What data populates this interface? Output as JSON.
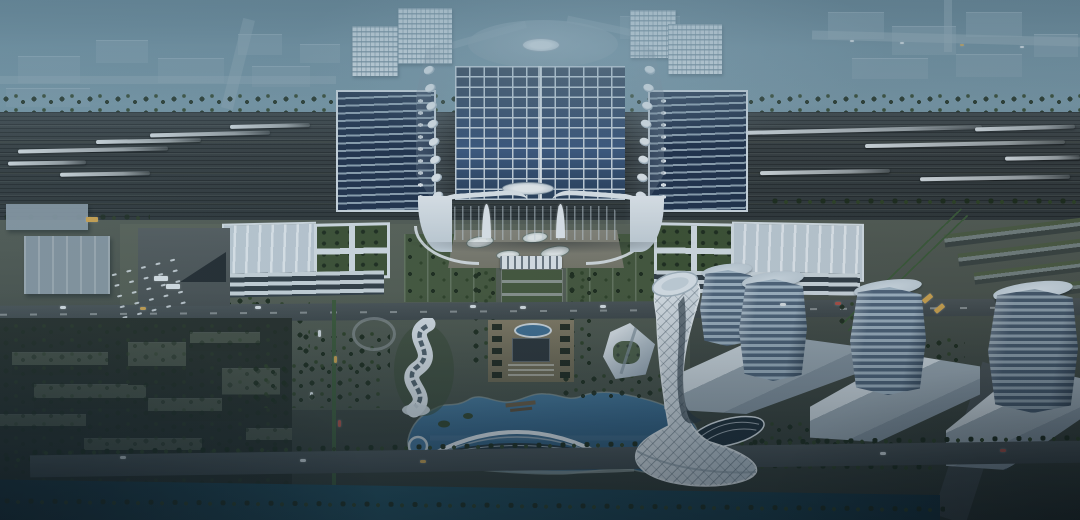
{
  "meta": {
    "title": "Aerial dusk rendering of a high-speed railway station complex with solar roof, landscaped axis, lake and towers",
    "type": "architectural-rendering",
    "time_of_day": "dusk"
  },
  "scene": {
    "city": {
      "label": "hazy distant city blocks and highways"
    },
    "tracks": {
      "label": "railway yard with high-speed trains on platforms",
      "train_count": 12
    },
    "station": {
      "label": "main station hall with rooftop solar array and leaf skylights",
      "solar_rows": 13,
      "solar_cols": 12,
      "skylights_per_side": 8
    },
    "wings": {
      "label": "green-roof terminal wing buildings",
      "count": 2
    },
    "plaza": {
      "label": "formal landscaped central axis plaza with gate and amphitheatre"
    },
    "lake": {
      "label": "crescent lake with arched glass pavilion bridge and round pond"
    },
    "iconic_tower": {
      "label": "twisted white lattice observation tower with flared base"
    },
    "office_towers": {
      "label": "glass office towers on white podium blocks",
      "count": 4
    },
    "wavy_building": {
      "label": "s-shaped ribbon cultural building"
    },
    "residential": {
      "label": "low-rise residential blocks at dusk"
    },
    "canal": {
      "label": "tree-lined canal along the south edge"
    }
  },
  "palette": {
    "sky_top": "#4e6d7c",
    "sky_high": "#6d8d9c",
    "sky_mid": "#7b9aa8",
    "far_block": "#8aa3b0",
    "far_light": "#e4ecf1",
    "city_road": "#9eb2bc",
    "tree_dark": "#1d2a18",
    "tree_mid": "#2f4123",
    "tree_light": "#4a6132",
    "track_bed": "#35393a",
    "train": "#e5ebee",
    "roof_bright": "#edf2f6",
    "roof_white": "#ccd6de",
    "roof_shade": "#a0aeba",
    "panel_dark": "#20304a",
    "panel_blue": "#3e5a81",
    "panel_rib": "#cdd8e1",
    "glass_dark": "#313c44",
    "shed_rib": "#93a6b5",
    "wing_roof": "#c8d3db",
    "garden": "#3e5130",
    "facade_band": "#d4dde2",
    "facade_glass": "#333d44",
    "plaza": "#5d6457",
    "path": "#909890",
    "lawn": "#47583a",
    "apron": "#8b887b",
    "lake_light": "#558bac",
    "lake_mid": "#447499",
    "lake_deep": "#2b5573",
    "shore": "#97a29d",
    "canal": "#16333f",
    "canal_glint": "#215060",
    "road": "#4d5455",
    "road_dark": "#414849",
    "lane": "#9aa0a2",
    "median": "#3d5a36",
    "car_white": "#e6ecef",
    "car_amber": "#d7a94e",
    "car_red": "#b65044",
    "resid_roof": "#4b5345",
    "ground_dark": "#272d26",
    "tower_light": "#a7bac8",
    "tower_dark": "#52667b",
    "tower_cap": "#d9e3ea",
    "podium_light": "#dde5ea",
    "podium_mid": "#a3b0b9",
    "podium_dark": "#39464f",
    "white_struct": "#e9eff3",
    "pale_slab": "#93a2ad",
    "slab_grey": "#77827f",
    "slab_green": "#4e5c42",
    "dock": "#6b5a40"
  }
}
